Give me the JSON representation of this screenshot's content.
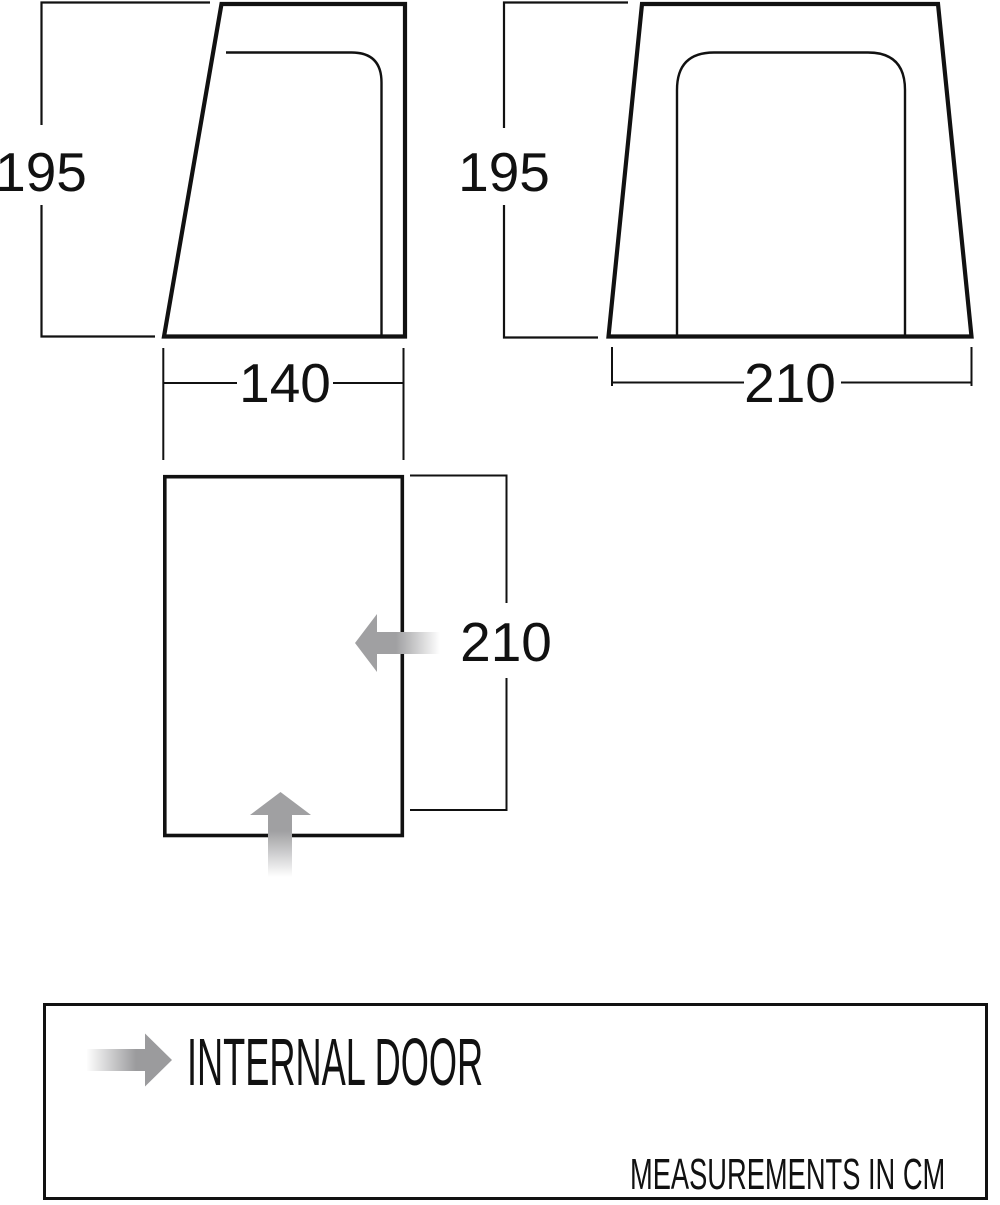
{
  "figure": {
    "title": "tent-dimension-diagram",
    "side_view": {
      "height_cm": "195",
      "width_cm": "140"
    },
    "front_view": {
      "height_cm": "195",
      "width_cm": "210"
    },
    "floor_plan": {
      "depth_cm": "210",
      "doors": [
        "left-pointing internal door arrow on right wall",
        "up-pointing internal door arrow on bottom wall"
      ]
    },
    "legend": {
      "internal_door_label": "INTERNAL DOOR",
      "measurements_note": "MEASUREMENTS IN CM"
    },
    "colors": {
      "line": "#111111",
      "arrow_gray": "#a0a0a2",
      "arrow_fade": "#ffffff",
      "background": "#ffffff"
    }
  }
}
